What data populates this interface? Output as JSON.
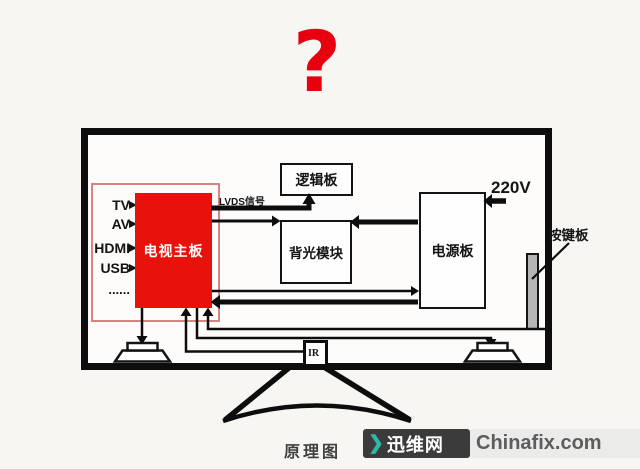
{
  "title_mark": "?",
  "tv": {
    "inputs": [
      "TV",
      "AV",
      "HDMI",
      "USB",
      "......"
    ],
    "mainboard_label": "电视主板",
    "lvds_label": "LVDS信号",
    "logic_board_label": "逻辑板",
    "backlight_label": "背光模块",
    "power_board_label": "电源板",
    "voltage_label": "220V",
    "keypad_label": "按键板",
    "ir_label": "IR"
  },
  "caption": "原理图",
  "watermark": {
    "chevron": "❯",
    "site_name_cn": "迅维网",
    "site_domain": "Chinafix.com"
  },
  "colors": {
    "mainboard_red": "#e8120c",
    "question_red": "#e8000f",
    "pink_border": "#d98383",
    "teal_chevron": "#30b7a8",
    "keypad_gray": "#b5b5b5"
  }
}
